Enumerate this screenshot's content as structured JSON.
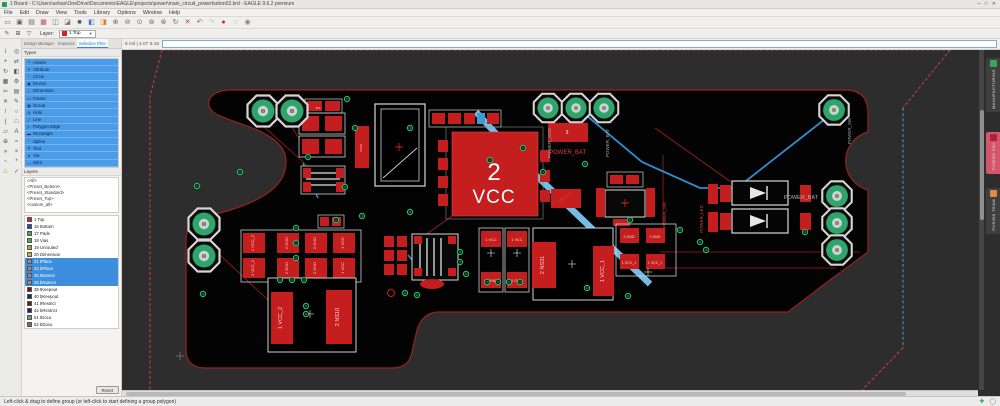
{
  "window": {
    "title": "1 Board - C:\\Users\\sebas\\OneDrive\\Documents\\EAGLE\\projects\\power\\main_circuit_powerbutton03.brd - EAGLE 9.6.2 premium",
    "menus": [
      "File",
      "Edit",
      "Draw",
      "View",
      "Tools",
      "Library",
      "Options",
      "Window",
      "Help"
    ],
    "window_buttons": [
      {
        "name": "minimize-button",
        "glyph": "─"
      },
      {
        "name": "maximize-button",
        "glyph": "□"
      },
      {
        "name": "close-button",
        "glyph": "✕"
      }
    ]
  },
  "toolbar": {
    "icons": [
      {
        "name": "open-icon",
        "glyph": "▭",
        "color": "#666"
      },
      {
        "name": "save-icon",
        "glyph": "▣",
        "color": "#666"
      },
      {
        "name": "print-icon",
        "glyph": "▤",
        "color": "#666"
      },
      {
        "name": "image-export-icon",
        "glyph": "▦",
        "color": "#c0504d"
      },
      {
        "name": "sheet-icon",
        "glyph": "◫",
        "color": "#777"
      },
      {
        "name": "chart-icon",
        "glyph": "◪",
        "color": "#777"
      },
      {
        "name": "board-icon",
        "glyph": "■",
        "color": "#555"
      },
      {
        "name": "layer-color-icon",
        "glyph": "◧",
        "color": "#3a7bd5"
      },
      {
        "name": "display-options-icon",
        "glyph": "◨",
        "color": "#e07b2a"
      },
      {
        "name": "zoom-in-icon",
        "glyph": "⊕",
        "color": "#666"
      },
      {
        "name": "zoom-out-icon",
        "glyph": "⊖",
        "color": "#666"
      },
      {
        "name": "zoom-fit-icon",
        "glyph": "⊙",
        "color": "#666"
      },
      {
        "name": "zoom-select-icon",
        "glyph": "⊚",
        "color": "#666"
      },
      {
        "name": "zoom-redraw-icon",
        "glyph": "⊛",
        "color": "#666"
      },
      {
        "name": "refresh-icon",
        "glyph": "↻",
        "color": "#666"
      },
      {
        "name": "scissors-icon",
        "glyph": "✕",
        "color": "#b04040"
      },
      {
        "name": "undo-icon",
        "glyph": "↶",
        "color": "#666"
      },
      {
        "name": "redo-icon",
        "glyph": "↷",
        "color": "#c2c2c2"
      },
      {
        "name": "record-icon",
        "glyph": "●",
        "color": "#cc2b2b"
      },
      {
        "name": "ring-icon",
        "glyph": "○",
        "color": "#b0b0b0"
      },
      {
        "name": "account-icon",
        "glyph": "◉",
        "color": "#888"
      }
    ]
  },
  "layerbar": {
    "icons": [
      {
        "name": "pencil-icon",
        "glyph": "✎"
      },
      {
        "name": "grid-icon",
        "glyph": "⊞"
      },
      {
        "name": "filter-icon",
        "glyph": "▽"
      }
    ],
    "label": "Layer:",
    "selected": "1 Top",
    "selected_color": "#d42222"
  },
  "coordbar": {
    "grid": "5 mil | 4.07 9.15"
  },
  "tool_column": [
    {
      "name": "info-tool-icon",
      "glyph": "i"
    },
    {
      "name": "eye-tool-icon",
      "glyph": "◎"
    },
    {
      "name": "move-tool-icon",
      "glyph": "+"
    },
    {
      "name": "swap-tool-icon",
      "glyph": "⇄"
    },
    {
      "name": "rotate-tool-icon",
      "glyph": "↻"
    },
    {
      "name": "mirror-tool-icon",
      "glyph": "◧"
    },
    {
      "name": "group-tool-icon",
      "glyph": "▦"
    },
    {
      "name": "change-tool-icon",
      "glyph": "⚙"
    },
    {
      "name": "cut-tool-icon",
      "glyph": "✂"
    },
    {
      "name": "paste-tool-icon",
      "glyph": "▤"
    },
    {
      "name": "delete-tool-icon",
      "glyph": "✕"
    },
    {
      "name": "name-tool-icon",
      "glyph": "✎"
    },
    {
      "name": "wire-tool-icon",
      "glyph": "/"
    },
    {
      "name": "circle-tool-icon",
      "glyph": "○"
    },
    {
      "name": "arc-tool-icon",
      "glyph": "("
    },
    {
      "name": "rect-tool-icon",
      "glyph": "□"
    },
    {
      "name": "polygon-tool-icon",
      "glyph": "▱"
    },
    {
      "name": "text-tool-icon",
      "glyph": "A"
    },
    {
      "name": "via-tool-icon",
      "glyph": "⊕"
    },
    {
      "name": "signal-tool-icon",
      "glyph": "≈"
    },
    {
      "name": "route-tool-icon",
      "glyph": "»"
    },
    {
      "name": "ripup-tool-icon",
      "glyph": "×"
    },
    {
      "name": "meander-tool-icon",
      "glyph": "~"
    },
    {
      "name": "ratsnest-tool-icon",
      "glyph": "*"
    },
    {
      "name": "errors-tool-icon",
      "glyph": "⚠",
      "color": "#dd9900"
    },
    {
      "name": "drc-tool-icon",
      "glyph": "✓"
    }
  ],
  "sidebar": {
    "tabs": [
      {
        "label": "Design Manager",
        "active": false
      },
      {
        "label": "Inspector",
        "active": false
      },
      {
        "label": "Selection Filter",
        "active": true
      }
    ],
    "types_header": "Types",
    "types": [
      {
        "label": "Airwire",
        "glyph": "≈"
      },
      {
        "label": "Attribute",
        "glyph": "✎"
      },
      {
        "label": "Circle",
        "glyph": "○"
      },
      {
        "label": "Device",
        "glyph": "▣"
      },
      {
        "label": "Dimension",
        "glyph": "↔"
      },
      {
        "label": "Frame",
        "glyph": "▭"
      },
      {
        "label": "Group",
        "glyph": "▦"
      },
      {
        "label": "Hole",
        "glyph": "◎"
      },
      {
        "label": "Line",
        "glyph": "╱"
      },
      {
        "label": "Polygon Edge",
        "glyph": "▷"
      },
      {
        "label": "Rectangle",
        "glyph": "▬"
      },
      {
        "label": "Spline",
        "glyph": "~"
      },
      {
        "label": "Text",
        "glyph": "A"
      },
      {
        "label": "Via",
        "glyph": "●"
      },
      {
        "label": "Wire",
        "glyph": "—"
      }
    ],
    "layers_header": "Layers",
    "presets": [
      "<All>",
      "<Preset_Bottom>",
      "<Preset_Standard>",
      "<Preset_Top>",
      "<custom_all>"
    ],
    "layers": [
      {
        "label": "1 Top",
        "color": "#d42222",
        "selected": false
      },
      {
        "label": "16 Bottom",
        "color": "#2244cc",
        "selected": false
      },
      {
        "label": "17 Pads",
        "color": "#3cb054",
        "selected": false
      },
      {
        "label": "18 Vias",
        "color": "#3cb054",
        "selected": false
      },
      {
        "label": "19 Unrouted",
        "color": "#a8a832",
        "selected": false
      },
      {
        "label": "20 Dimension",
        "color": "#c0b040",
        "selected": false
      },
      {
        "label": "21 tPlace",
        "color": "#909090",
        "selected": true
      },
      {
        "label": "22 bPlace",
        "color": "#909090",
        "selected": true
      },
      {
        "label": "25 tNames",
        "color": "#909090",
        "selected": true
      },
      {
        "label": "26 bNames",
        "color": "#909090",
        "selected": true
      },
      {
        "label": "39 tKeepout",
        "color": "#701818",
        "selected": false
      },
      {
        "label": "40 bKeepout",
        "color": "#182870",
        "selected": false
      },
      {
        "label": "41 tRestrict",
        "color": "#701818",
        "selected": false
      },
      {
        "label": "42 bRestrict",
        "color": "#182870",
        "selected": false
      },
      {
        "label": "51 tDocu",
        "color": "#8a8a8a",
        "selected": false
      },
      {
        "label": "52 bDocu",
        "color": "#6e6e6e",
        "selected": false
      }
    ],
    "reset_label": "Reset"
  },
  "board": {
    "big_chip": {
      "designator": "2",
      "name": "VCC"
    },
    "power_bat": {
      "designator": "3",
      "name": "POWER_BAT"
    },
    "menu_label": "MENU",
    "pad_labels": {
      "top_left_vertical": "POWER_GND",
      "top_right_vertical": "POWER_BAT",
      "right_top_vertical": "POWER_SW",
      "right_mid": "POWER_BAT"
    },
    "diode_labels": [
      "POWER_SW",
      "POWER_LED"
    ],
    "chips": {
      "ns31": "2 NS31",
      "vcc_1": "1 VCC_1",
      "vcc_2": "1 VCC_2",
      "ns10": "2 NS10"
    },
    "grid_row1": [
      "1 VCC_2",
      "2 GND",
      "2 GND",
      "1 VCC"
    ],
    "grid_row2": [
      "1 VCC_2",
      "2 GND",
      "2 GND",
      "1 VCC"
    ],
    "mid_pairs": [
      "1 VCC",
      "1 VCC",
      "2 GND",
      "2 GND"
    ],
    "right_pairs": [
      "2 GND",
      "2 GND",
      "1 VCC_1",
      "1 VCC_1"
    ],
    "tiny": {
      "vcco": "vcco",
      "vcc": "vcc"
    }
  },
  "right_rail": {
    "tabs": [
      {
        "label": "MANUFACTURING",
        "bg": "#3f3f3f",
        "icon_color": "#3aa65c",
        "active": false
      },
      {
        "label": "FUSION 360",
        "bg": "#d5556a",
        "icon_color": "#a82438",
        "active": true
      },
      {
        "label": "FUSION TEAM",
        "bg": "#3f3f3f",
        "icon_color": "#e8883a",
        "active": false
      }
    ]
  },
  "statusbar": {
    "text": "Left-click & drag to define group (or left-click to start defining a group polygon)",
    "icons": [
      {
        "name": "add-status-icon",
        "glyph": "✚",
        "cls": "st-plus"
      },
      {
        "name": "status-dot-icon",
        "glyph": "◯",
        "cls": "st-dot"
      }
    ]
  }
}
